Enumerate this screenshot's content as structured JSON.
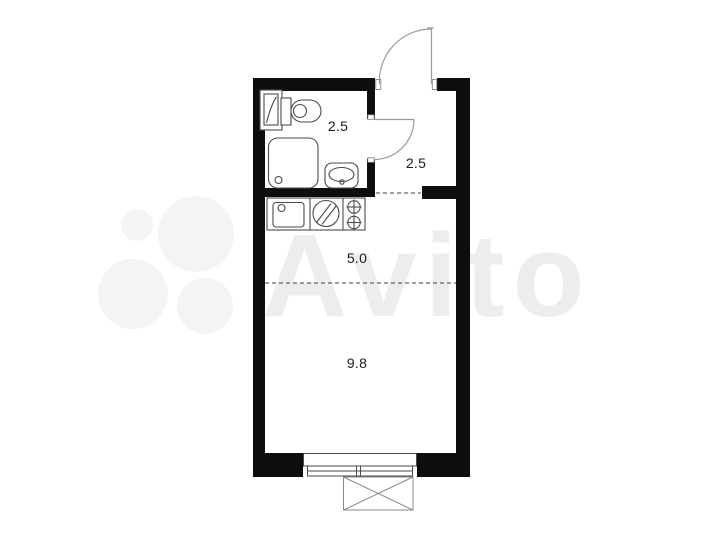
{
  "watermark": {
    "brand": "Avito"
  },
  "plan": {
    "rooms": [
      {
        "id": "bathroom",
        "area": "2.5"
      },
      {
        "id": "hallway",
        "area": "2.5"
      },
      {
        "id": "kitchen",
        "area": "5.0"
      },
      {
        "id": "living_room",
        "area": "9.8"
      }
    ]
  },
  "colors": {
    "wall": "#0e0e0e",
    "fixture_line": "#4a4a4a",
    "door_line": "#9b9b9b",
    "dash_line": "#3f3f3f",
    "label_text": "#1c1c1c",
    "watermark": "#ededed"
  }
}
